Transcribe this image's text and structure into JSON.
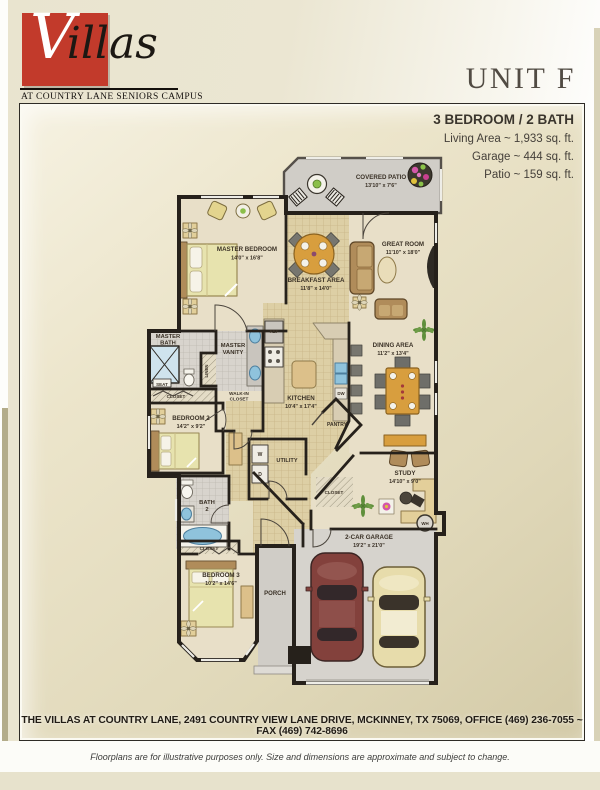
{
  "brand": {
    "logo_initial": "V",
    "logo_rest": "illas",
    "tagline": "AT COUNTRY LANE SENIORS CAMPUS",
    "brand_red": "#c23a2b"
  },
  "header": {
    "unit": "UNIT F"
  },
  "summary": {
    "headline": "3 BEDROOM / 2 BATH",
    "lines": [
      "Living Area ~ 1,933 sq. ft.",
      "Garage ~ 444 sq. ft.",
      "Patio ~ 159 sq. ft."
    ]
  },
  "rooms": {
    "covered_patio": {
      "name": "COVERED PATIO",
      "dims": "13'10\" x 7'6\""
    },
    "master_bedroom": {
      "name": "MASTER BEDROOM",
      "dims": "14'0\" x 16'8\""
    },
    "breakfast_area": {
      "name": "BREAKFAST AREA",
      "dims": "11'8\" x 14'0\""
    },
    "great_room": {
      "name": "GREAT ROOM",
      "dims": "11'10\" x 18'0\""
    },
    "master_bath": {
      "line1": "MASTER",
      "line2": "BATH"
    },
    "master_vanity": {
      "line1": "MASTER",
      "line2": "VANITY"
    },
    "kitchen": {
      "name": "KITCHEN",
      "dims": "10'4\" x 17'4\""
    },
    "dining_area": {
      "name": "DINING AREA",
      "dims": "11'2\" x 13'4\""
    },
    "bedroom_2": {
      "name": "BEDROOM 2",
      "dims": "14'2\" x 9'2\""
    },
    "utility": {
      "name": "UTILITY"
    },
    "pantry": {
      "name": "PANTRY"
    },
    "study": {
      "name": "STUDY",
      "dims": "14'10\" x 9'0\""
    },
    "bath_2": {
      "line1": "BATH",
      "line2": "2"
    },
    "bedroom_3": {
      "name": "BEDROOM 3",
      "dims": "10'2\" x 14'6\""
    },
    "porch": {
      "name": "PORCH"
    },
    "garage": {
      "name": "2-CAR GARAGE",
      "dims": "19'2\" x 21'0\""
    }
  },
  "fixtures": {
    "seat": "SEAT",
    "linen": "LINEN",
    "closet": "CLOSET",
    "walk_in_line1": "WALK-IN",
    "walk_in_line2": "CLOSET",
    "ref": "REF",
    "dw": "DW",
    "washer": "W",
    "dryer": "D",
    "water_heater": "WH"
  },
  "footer": {
    "address": "THE VILLAS AT COUNTRY LANE, 2491 COUNTRY VIEW LANE DRIVE, MCKINNEY, TX  75069, OFFICE (469) 236-7055 ~ FAX (469) 742-8696",
    "disclaimer": "Floorplans are for illustrative purposes only. Size and dimensions are approximate and subject to change."
  },
  "colors": {
    "brand_red": "#c23a2b",
    "page_beige": "#e9e4cf",
    "wall": "#26211b",
    "carpet": "#e8dfc8",
    "tile_tan": "#ddcfa5",
    "tile_gray": "#d8d4cd",
    "concrete": "#d3d0ca",
    "wood_accent": "#d89e3e",
    "fixture_blue": "#8fc3dc",
    "car_maroon": "#83413c",
    "car_cream": "#e7dcab"
  }
}
